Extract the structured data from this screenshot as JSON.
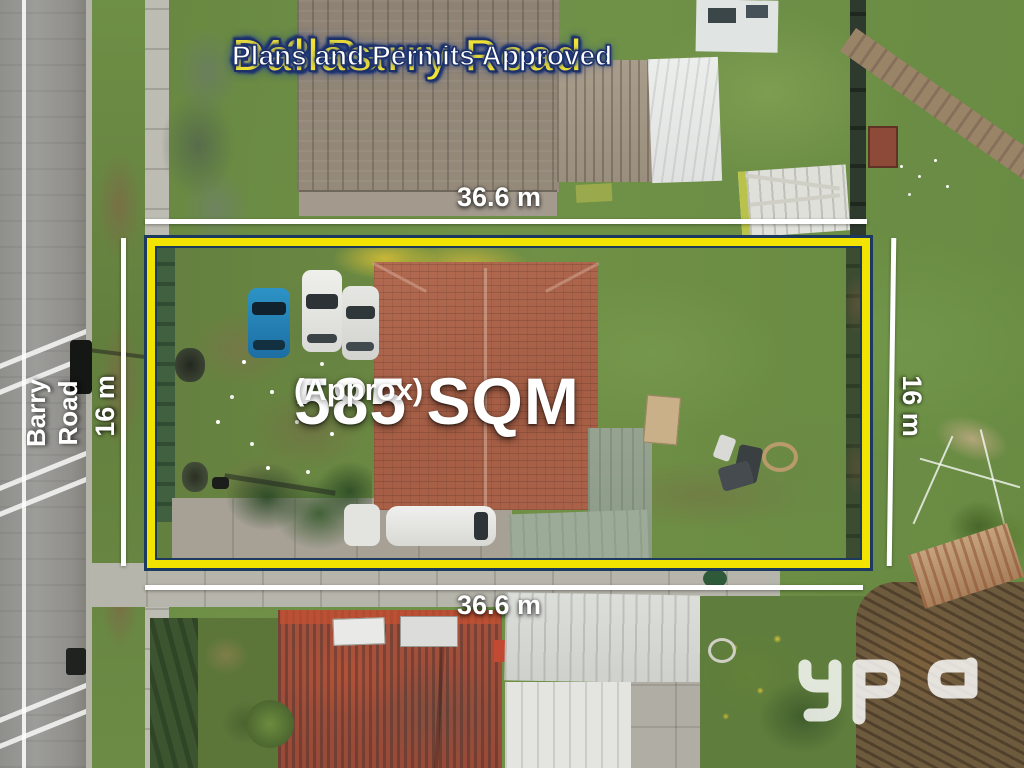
{
  "listing": {
    "title_line1": "443 Barry Road",
    "title_line2": "Dallas",
    "subtitle": "Plans and Permits Approved"
  },
  "dimensions": {
    "top": "36.6 m",
    "bottom": "36.6 m",
    "left": "16 m",
    "right": "16 m"
  },
  "area": {
    "value": "585 SQM",
    "qualifier": "(Approx)"
  },
  "road": {
    "name": "Barry Road"
  },
  "logo": {
    "text": "ypa"
  },
  "colors": {
    "title_yellow": "#f2e435",
    "outline_navy": "#1d3066",
    "boundary_yellow": "#f2e400",
    "boundary_navy": "#1c3a5e",
    "dimension_white": "#ffffff"
  }
}
